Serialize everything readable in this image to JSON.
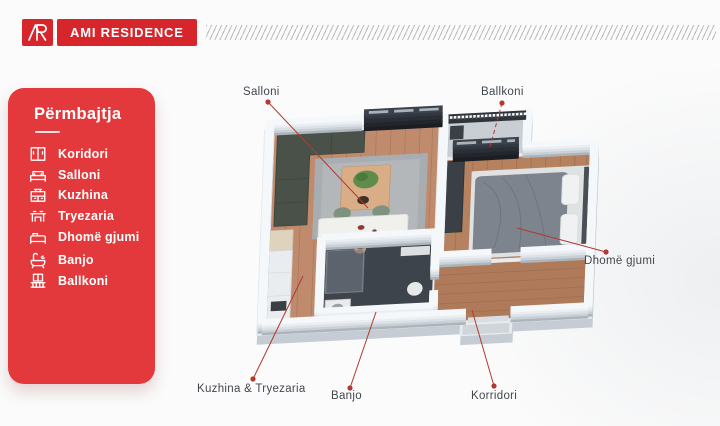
{
  "header": {
    "brand": "AMI RESIDENCE",
    "monogram": "AR"
  },
  "sidebar": {
    "title": "Përmbajtja",
    "items": [
      {
        "label": "Koridori",
        "icon": "corridor-icon"
      },
      {
        "label": "Salloni",
        "icon": "sofa-icon"
      },
      {
        "label": "Kuzhina",
        "icon": "kitchen-icon"
      },
      {
        "label": "Tryezaria",
        "icon": "dining-table-icon"
      },
      {
        "label": "Dhomë gjumi",
        "icon": "bed-icon"
      },
      {
        "label": "Banjo",
        "icon": "bathtub-icon"
      },
      {
        "label": "Ballkoni",
        "icon": "balcony-icon"
      }
    ]
  },
  "callouts": [
    {
      "label": "Salloni"
    },
    {
      "label": "Ballkoni"
    },
    {
      "label": "Dhomë gjumi"
    },
    {
      "label": "Kuzhina & Tryezaria"
    },
    {
      "label": "Banjo"
    },
    {
      "label": "Korridori"
    }
  ],
  "colors": {
    "brand_red": "#D6262C",
    "panel_red": "#E4393C",
    "callout_line_red": "#B03A31",
    "callout_text": "#43484E",
    "wood_floor": "#C08B6D",
    "wall_white": "#F5F8FA"
  }
}
